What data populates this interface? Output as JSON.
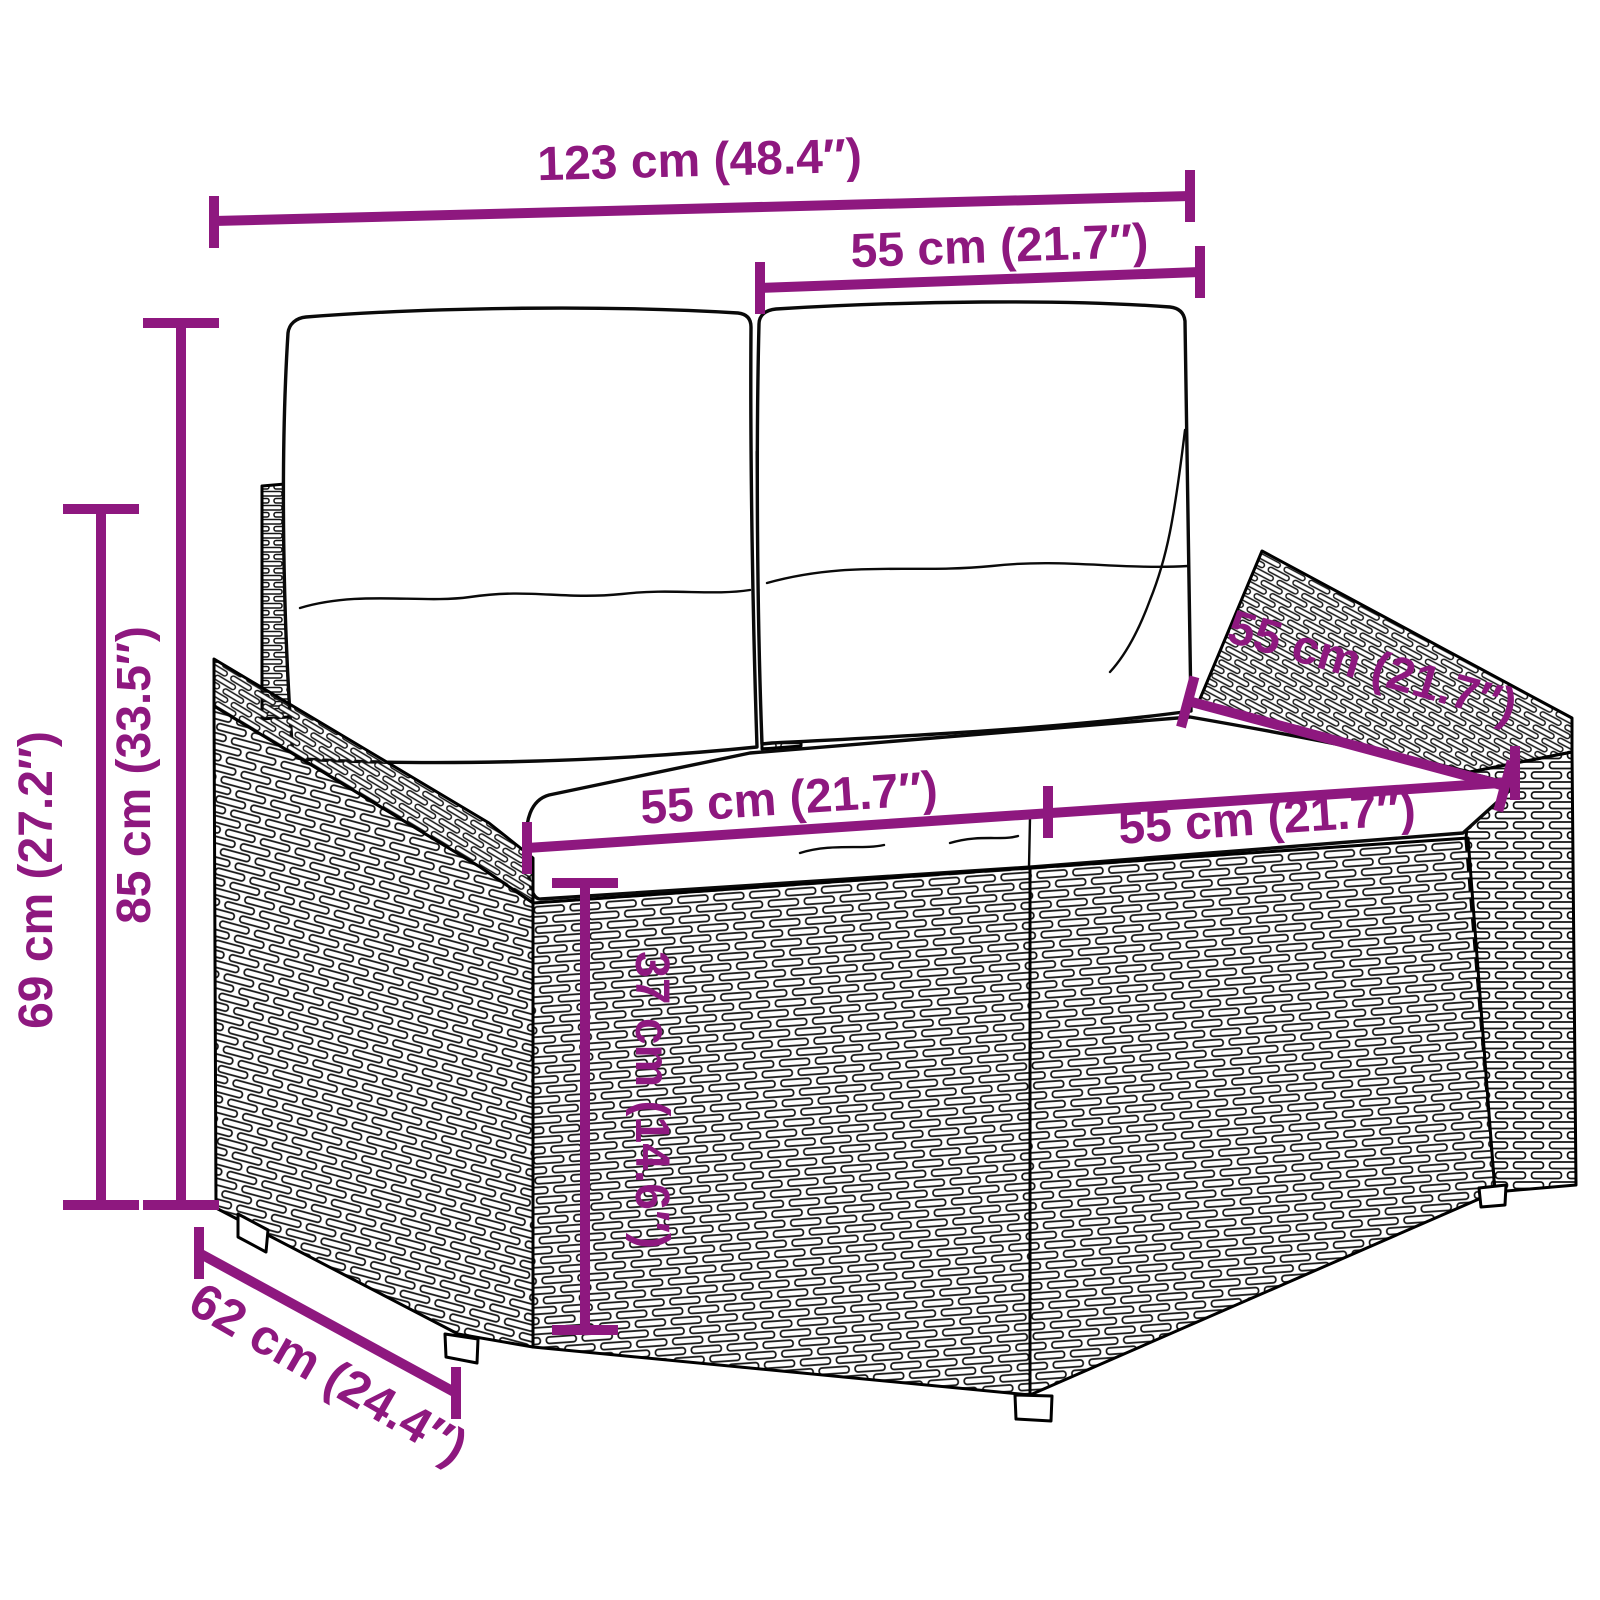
{
  "meta": {
    "title": "Poly rattan 2-seater garden sofa with cushions — dimension diagram",
    "background": "#ffffff",
    "accent_color": "#8E187F",
    "drawing_color": "#000000"
  },
  "dims": {
    "overall_width": {
      "label": "123 cm (48.4″)"
    },
    "backrest_width": {
      "label": "55 cm (21.7″)"
    },
    "total_height": {
      "label": "85 cm (33.5″)"
    },
    "armrest_height": {
      "label": "69 cm (27.2″)"
    },
    "seat_width_left": {
      "label": "55 cm (21.7″)"
    },
    "seat_width_right": {
      "label": "55 cm (21.7″)"
    },
    "seat_depth": {
      "label": "55 cm (21.7″)"
    },
    "seat_height": {
      "label": "37 cm (14.6″)"
    },
    "overall_depth": {
      "label": "62 cm (24.4″)"
    }
  }
}
